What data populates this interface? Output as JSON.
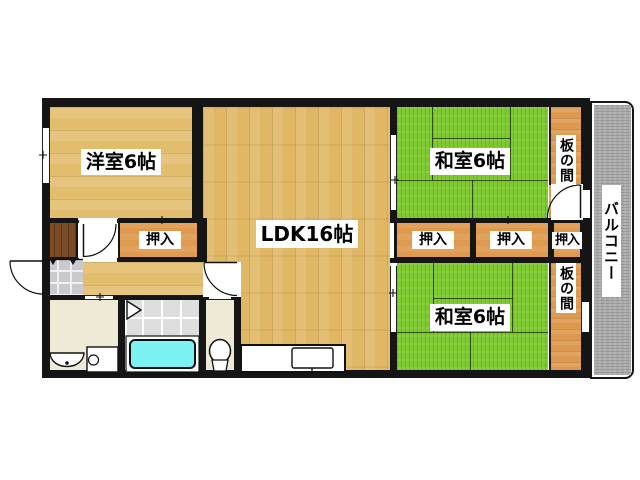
{
  "document_type": "apartment-floor-plan",
  "labels": {
    "western_room": "洋室6帖",
    "ldk": "LDK16帖",
    "japanese_room_top": "和室6帖",
    "japanese_room_bottom": "和室6帖",
    "closet_left": "押入",
    "closet_top_a": "押入",
    "closet_top_b": "押入",
    "closet_top_c": "押入",
    "wood_alcove_top": "板の間",
    "wood_alcove_bottom": "板の間",
    "balcony": "バルコニー"
  },
  "colors": {
    "wall": "#151515",
    "wood_floor_tan": "#e3bd6e",
    "tatami_green": "#7dc92f",
    "closet_orange": "#e09a50",
    "wood_alcove_orange": "#dd9a4e",
    "balcony_gray": "#ababab",
    "bathtub_cyan": "#7df2f2",
    "wet_room_cream": "#eeead6",
    "entry_storage_brown": "#7b4b26",
    "bath_tile_gray": "#dedede",
    "entry_tile_gray": "#c9c9ce"
  }
}
